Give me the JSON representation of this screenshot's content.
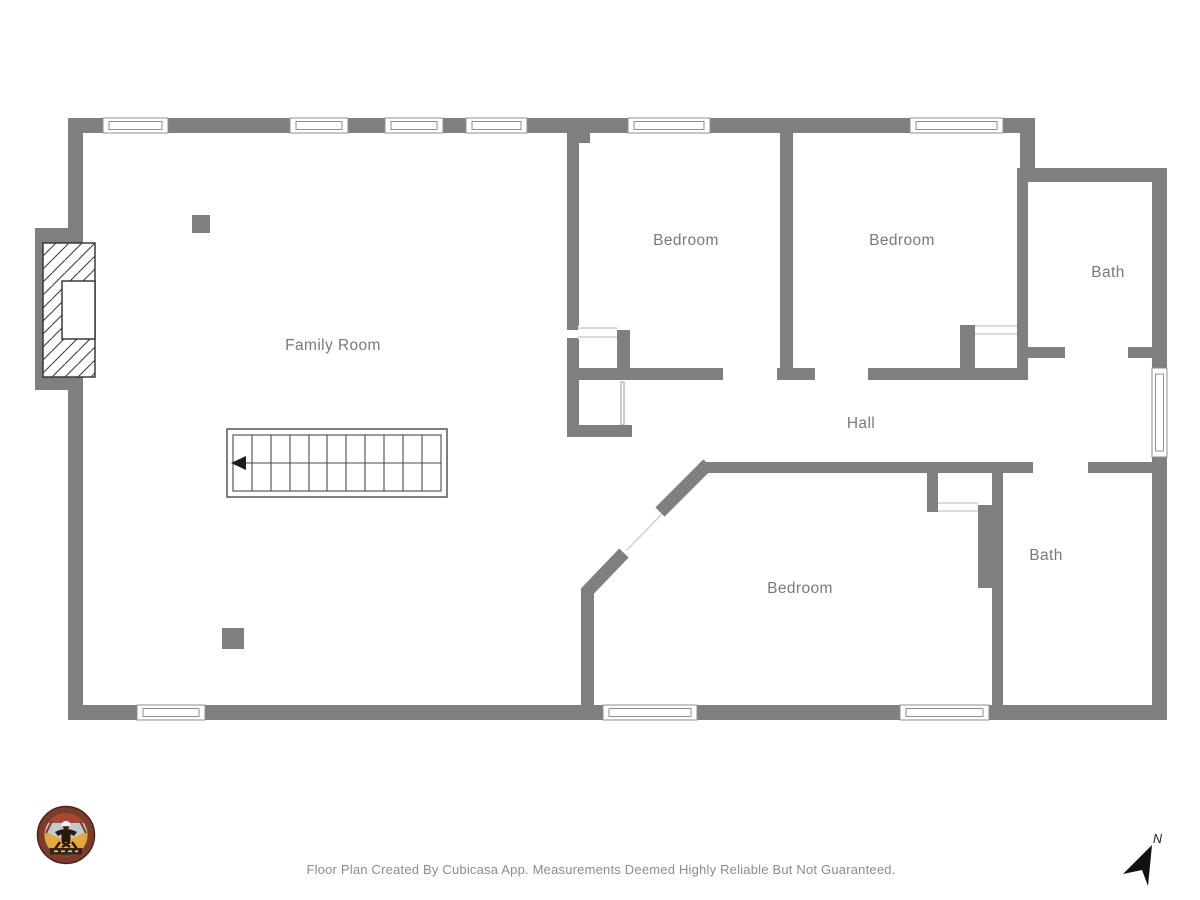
{
  "floor_plan": {
    "wall_color": "#7f7f7f",
    "label_color": "#7a7a7a",
    "rooms": [
      {
        "id": "family-room",
        "label": "Family Room"
      },
      {
        "id": "bedroom-top-left",
        "label": "Bedroom"
      },
      {
        "id": "bedroom-top-right",
        "label": "Bedroom"
      },
      {
        "id": "bath-top",
        "label": "Bath"
      },
      {
        "id": "hall",
        "label": "Hall"
      },
      {
        "id": "bedroom-bottom",
        "label": "Bedroom"
      },
      {
        "id": "bath-bottom",
        "label": "Bath"
      }
    ],
    "features": [
      "stairs",
      "fireplace",
      "windows",
      "door-openings"
    ]
  },
  "compass": {
    "north_label": "N"
  },
  "footer": {
    "disclaimer": "Floor Plan Created By Cubicasa App. Measurements Deemed Highly Reliable But Not Guaranteed."
  }
}
